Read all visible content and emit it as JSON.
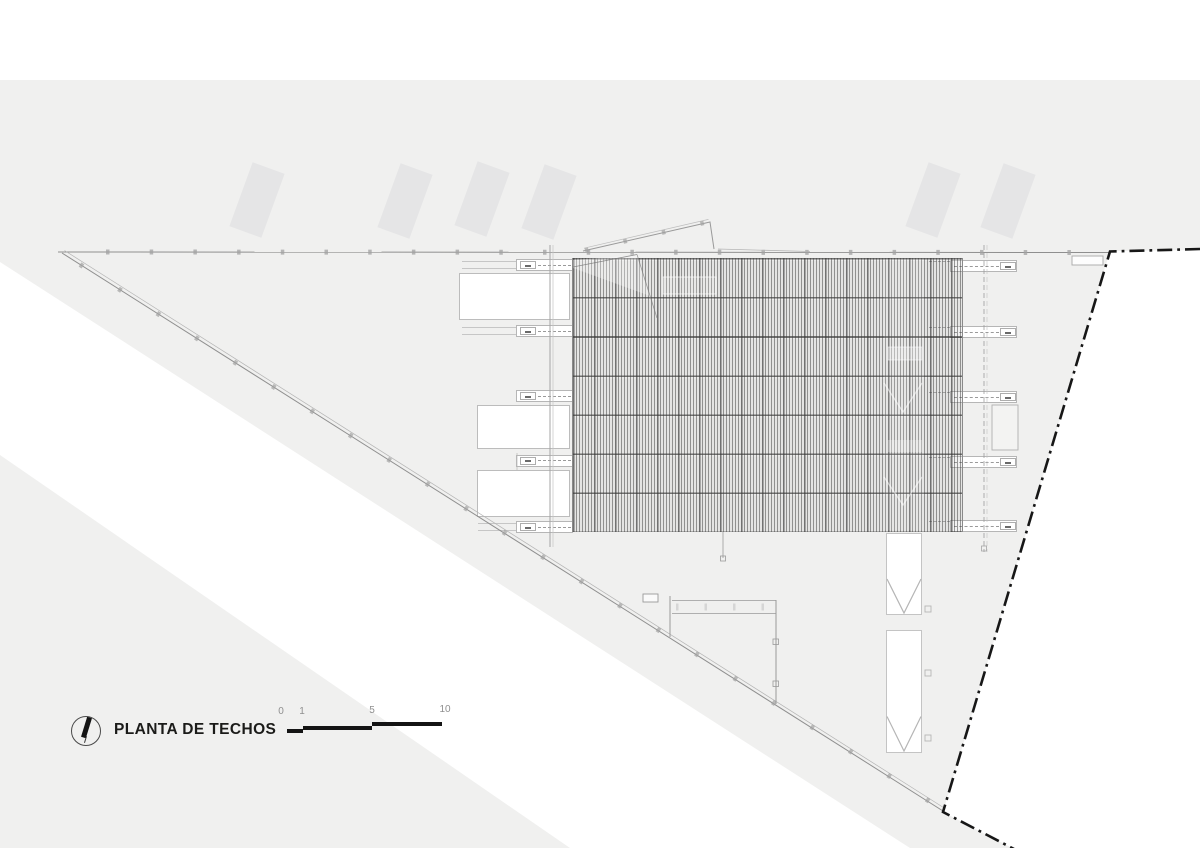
{
  "title_block": {
    "north_icon": "north-arrow-icon",
    "title": "PLANTA DE TECHOS"
  },
  "scale_bar": {
    "labels": [
      "0",
      "1",
      "5",
      "10"
    ]
  },
  "colors": {
    "page_background": "#ffffff",
    "site_fill": "#f0f0ef",
    "shadow_block_fill": "#e5e5e6",
    "drawing_line": "#9a9a9a",
    "property_line_dashdot": "#171717",
    "roof_hatch_line": "#555555",
    "canopy_fill": "#ffffff",
    "title_text": "#1b1b19",
    "scale_label_text": "#8f8f8f",
    "scale_bar_fill": "#141414"
  }
}
